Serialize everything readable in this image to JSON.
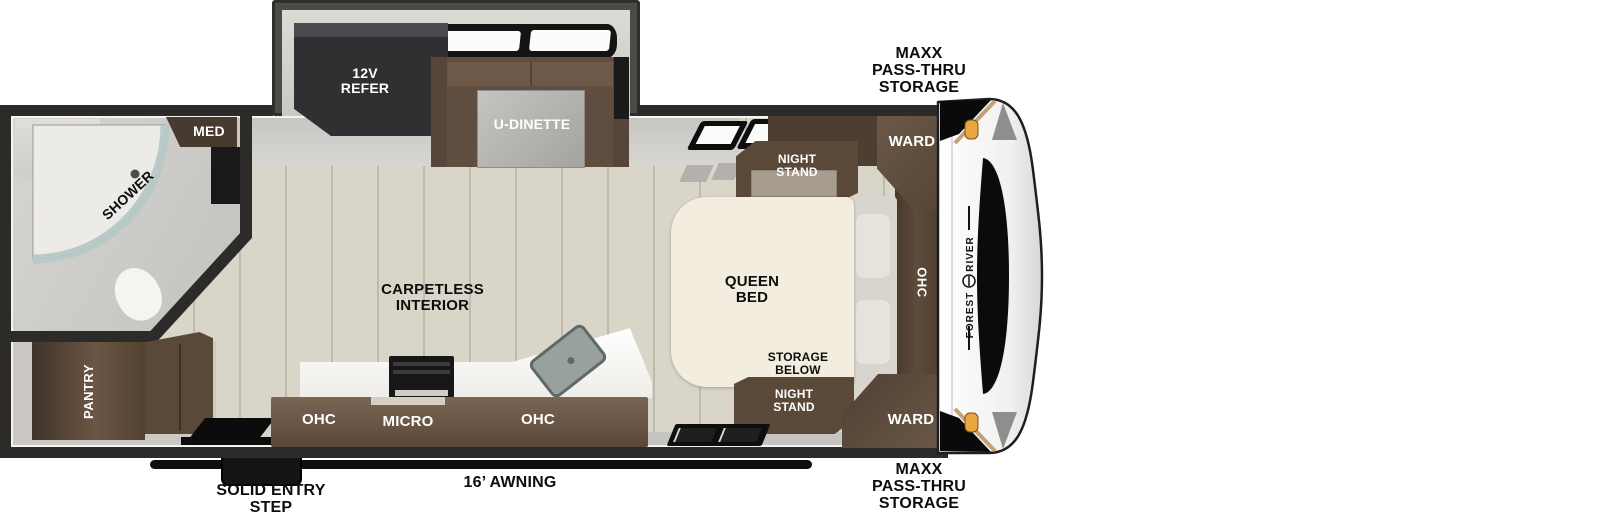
{
  "branding": {
    "make": "FOREST RIVER",
    "word1": "FOREST",
    "word2": "RIVER"
  },
  "exterior": {
    "front_storage_top": {
      "lines": [
        "MAXX",
        "PASS-THRU",
        "STORAGE"
      ]
    },
    "front_storage_bottom": {
      "lines": [
        "MAXX",
        "PASS-THRU",
        "STORAGE"
      ]
    },
    "awning_label": "16’ AWNING",
    "entry_step": {
      "lines": [
        "SOLID ENTRY",
        "STEP"
      ]
    }
  },
  "slide_out": {
    "refrigerator": {
      "lines": [
        "12V",
        "REFER"
      ]
    },
    "dinette_label": "U-DINETTE"
  },
  "bedroom": {
    "ward_front_top": "WARD",
    "ward_front_bottom": "WARD",
    "night_stand_top": {
      "lines": [
        "NIGHT",
        "STAND"
      ]
    },
    "night_stand_bottom": {
      "lines": [
        "NIGHT",
        "STAND"
      ]
    },
    "storage_below_top": {
      "lines": [
        "STORAGE",
        "BELOW"
      ]
    },
    "storage_below_bottom": {
      "lines": [
        "STORAGE",
        "BELOW"
      ]
    },
    "bed_label": {
      "lines": [
        "QUEEN",
        "BED"
      ]
    },
    "overhead_cabinet": "OHC"
  },
  "bathroom": {
    "medicine_cabinet": "MED",
    "shower_label": "SHOWER"
  },
  "kitchen": {
    "overhead_left": "OHC",
    "microwave": "MICRO",
    "overhead_right": "OHC",
    "pantry": "PANTRY"
  },
  "living_area": {
    "flooring": {
      "lines": [
        "CARPETLESS",
        "INTERIOR"
      ]
    }
  },
  "colors": {
    "wall": "#2c2b29",
    "slide_wall": "#4a4845",
    "floor_wood": "#d8d4c8",
    "floor_gray": "#cac8c4",
    "cabinet_brown": "#5e4c3e",
    "cabinet_brown_dark": "#4c3d31",
    "bed_cream": "#f2edde",
    "shower_glass": "#b7c8c6",
    "marker_amber": "#e8a63c",
    "accent_tan": "#c3a177",
    "label_black": "#0d0d0d",
    "label_white": "#ffffff"
  }
}
